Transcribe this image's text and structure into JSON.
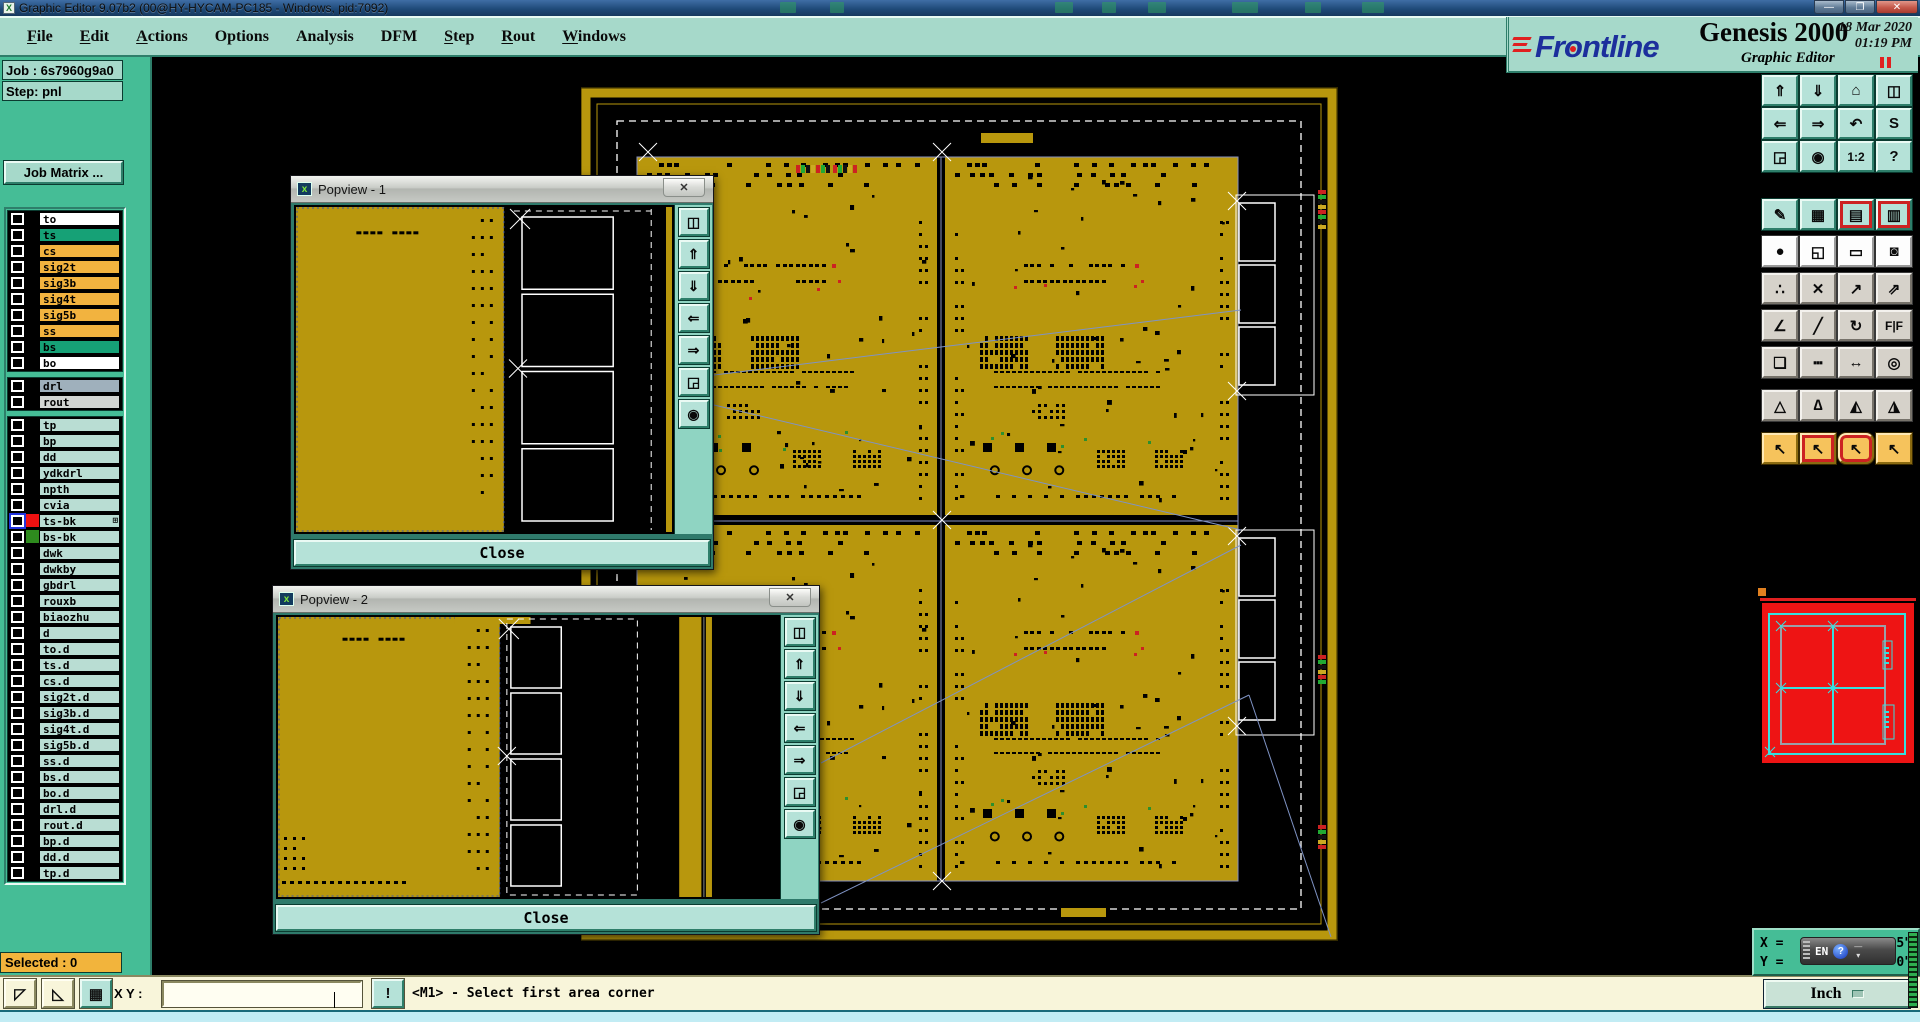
{
  "title_bar": {
    "title": "Graphic Editor 9.07b2 (00@HY-HYCAM-PC185 - Windows, pid:7092)",
    "controls": [
      {
        "name": "minimize",
        "glyph": "—"
      },
      {
        "name": "restore",
        "glyph": "❐"
      },
      {
        "name": "close",
        "glyph": "✕"
      }
    ]
  },
  "menu_bar": {
    "items": [
      {
        "label": "File",
        "u": 0
      },
      {
        "label": "Edit",
        "u": 0
      },
      {
        "label": "Actions",
        "u": 0
      },
      {
        "label": "Options",
        "u": -1
      },
      {
        "label": "Analysis",
        "u": -1
      },
      {
        "label": "DFM",
        "u": -1
      },
      {
        "label": "Step",
        "u": 0
      },
      {
        "label": "Rout",
        "u": 0
      },
      {
        "label": "Windows",
        "u": 0
      }
    ],
    "help": {
      "label": "Help"
    }
  },
  "branding": {
    "logo": "Frontline",
    "product": "Genesis 2000",
    "subtitle": "Graphic Editor",
    "date": "18 Mar 2020",
    "time": "01:19 PM"
  },
  "sidebar": {
    "job": "Job : 6s7960g9a0",
    "step": "Step: pnl",
    "job_matrix": "Job Matrix ...",
    "selected": "Selected : 0",
    "layer_groups": [
      {
        "rows": [
          {
            "label": "to",
            "bg": "#ffffff"
          },
          {
            "label": "ts",
            "bg": "#16a176"
          },
          {
            "label": "cs",
            "bg": "#f2b33f"
          },
          {
            "label": "sig2t",
            "bg": "#f2b33f"
          },
          {
            "label": "sig3b",
            "bg": "#f2b33f"
          },
          {
            "label": "sig4t",
            "bg": "#f2b33f"
          },
          {
            "label": "sig5b",
            "bg": "#f2b33f"
          },
          {
            "label": "ss",
            "bg": "#f2b33f"
          },
          {
            "label": "bs",
            "bg": "#16a176"
          },
          {
            "label": "bo",
            "bg": "#ffffff"
          }
        ]
      },
      {
        "rows": [
          {
            "label": "drl",
            "bg": "#9fb0bc"
          },
          {
            "label": "rout",
            "bg": "#d2d5d2"
          }
        ]
      },
      {
        "rows": [
          {
            "label": "tp",
            "bg": "#b9ddd3"
          },
          {
            "label": "bp",
            "bg": "#b9ddd3"
          },
          {
            "label": "dd",
            "bg": "#b9ddd3"
          },
          {
            "label": "ydkdrl",
            "bg": "#b9ddd3"
          },
          {
            "label": "npth",
            "bg": "#b9ddd3"
          },
          {
            "label": "cvia",
            "bg": "#b9ddd3"
          },
          {
            "label": "ts-bk",
            "bg": "#b9ddd3",
            "swatch": "#ee1111",
            "cb_accent": true,
            "mark": "⊞"
          },
          {
            "label": "bs-bk",
            "bg": "#b9ddd3",
            "swatch": "#2e8b1e"
          },
          {
            "label": "dwk",
            "bg": "#b9ddd3"
          },
          {
            "label": "dwkby",
            "bg": "#b9ddd3"
          },
          {
            "label": "gbdrl",
            "bg": "#b9ddd3"
          },
          {
            "label": "rouxb",
            "bg": "#b9ddd3"
          },
          {
            "label": "biaozhu",
            "bg": "#b9ddd3"
          },
          {
            "label": "d",
            "bg": "#b9ddd3"
          },
          {
            "label": "to.d",
            "bg": "#b9ddd3"
          },
          {
            "label": "ts.d",
            "bg": "#b9ddd3"
          },
          {
            "label": "cs.d",
            "bg": "#b9ddd3"
          },
          {
            "label": "sig2t.d",
            "bg": "#b9ddd3"
          },
          {
            "label": "sig3b.d",
            "bg": "#b9ddd3"
          },
          {
            "label": "sig4t.d",
            "bg": "#b9ddd3"
          },
          {
            "label": "sig5b.d",
            "bg": "#b9ddd3"
          },
          {
            "label": "ss.d",
            "bg": "#b9ddd3"
          },
          {
            "label": "bs.d",
            "bg": "#b9ddd3"
          },
          {
            "label": "bo.d",
            "bg": "#b9ddd3"
          },
          {
            "label": "drl.d",
            "bg": "#b9ddd3"
          },
          {
            "label": "rout.d",
            "bg": "#b9ddd3"
          },
          {
            "label": "bp.d",
            "bg": "#b9ddd3"
          },
          {
            "label": "dd.d",
            "bg": "#b9ddd3"
          },
          {
            "label": "tp.d",
            "bg": "#b9ddd3"
          }
        ]
      }
    ]
  },
  "popviews": [
    {
      "title": "Popview - 1",
      "close": "Close"
    },
    {
      "title": "Popview - 2",
      "close": "Close"
    }
  ],
  "popview_toolbar": [
    {
      "n": "detach-view",
      "g": "◫"
    },
    {
      "n": "pan-up",
      "g": "⇑"
    },
    {
      "n": "pan-down",
      "g": "⇓"
    },
    {
      "n": "pan-left",
      "g": "⇐"
    },
    {
      "n": "pan-right",
      "g": "⇒"
    },
    {
      "n": "zoom-out",
      "g": "◲"
    },
    {
      "n": "zoom-in",
      "g": "◉"
    }
  ],
  "right_toolbar": {
    "rows": [
      {
        "style": "teal",
        "buttons": [
          {
            "n": "pan-up",
            "g": "⇑"
          },
          {
            "n": "pan-down",
            "g": "⇓"
          },
          {
            "n": "home-view",
            "g": "⌂"
          },
          {
            "n": "zoom-window-xy",
            "g": "◫"
          }
        ]
      },
      {
        "style": "teal",
        "buttons": [
          {
            "n": "pan-left",
            "g": "⇐"
          },
          {
            "n": "pan-right",
            "g": "⇒"
          },
          {
            "n": "previous-view",
            "g": "↶"
          },
          {
            "n": "repeat-view",
            "g": "S"
          }
        ]
      },
      {
        "style": "teal",
        "buttons": [
          {
            "n": "zoom-out",
            "g": "◲"
          },
          {
            "n": "zoom-in",
            "g": "◉"
          },
          {
            "n": "scale-1-2",
            "g": "1:2"
          },
          {
            "n": "query-feature",
            "g": "?"
          }
        ]
      },
      {
        "style": "teal",
        "buttons": [
          {
            "n": "editor-setup",
            "g": "✎"
          },
          {
            "n": "snap-grid",
            "g": "▦"
          },
          {
            "n": "layer-display-a",
            "g": "▤",
            "s": "teal red-frame"
          },
          {
            "n": "layer-display-b",
            "g": "▥",
            "s": "teal red-frame"
          }
        ]
      },
      {
        "style": "white",
        "buttons": [
          {
            "n": "select-pad",
            "g": "●"
          },
          {
            "n": "highlight-net",
            "g": "◱"
          },
          {
            "n": "measure-ruler",
            "g": "▭"
          },
          {
            "n": "select-area-pad",
            "g": "◙"
          }
        ]
      },
      {
        "style": "gray",
        "buttons": [
          {
            "n": "net-endpoints",
            "g": "∴"
          },
          {
            "n": "unselect-all",
            "g": "✕"
          },
          {
            "n": "move-feature",
            "g": "↗"
          },
          {
            "n": "copy-feature",
            "g": "⇗"
          }
        ]
      },
      {
        "style": "gray",
        "buttons": [
          {
            "n": "measure-angle",
            "g": "∠"
          },
          {
            "n": "slant-line",
            "g": "╱"
          },
          {
            "n": "rotate-feature",
            "g": "↻"
          },
          {
            "n": "mirror-feature",
            "g": "F|F"
          }
        ]
      },
      {
        "style": "gray",
        "buttons": [
          {
            "n": "copy-to-layer",
            "g": "❏"
          },
          {
            "n": "break-line",
            "g": "┅"
          },
          {
            "n": "resize-feature",
            "g": "↔"
          },
          {
            "n": "surface-tool",
            "g": "◎"
          }
        ]
      },
      {
        "style": "gray",
        "buttons": [
          {
            "n": "arc-fillet-a",
            "g": "△"
          },
          {
            "n": "arc-fillet-b",
            "g": "∆"
          },
          {
            "n": "arc-fillet-c",
            "g": "◭"
          },
          {
            "n": "arc-fillet-d",
            "g": "◮"
          }
        ]
      },
      {
        "style": "orange",
        "buttons": [
          {
            "n": "select-mode-single",
            "g": "↖"
          },
          {
            "n": "select-mode-frame",
            "g": "↖",
            "s": "orange red-inner"
          },
          {
            "n": "select-mode-poly",
            "g": "↖",
            "s": "orange red-oct"
          },
          {
            "n": "select-mode-net",
            "g": "↖"
          }
        ]
      }
    ]
  },
  "status_bar": {
    "tools": [
      {
        "n": "profile-corner-a",
        "g": "◸"
      },
      {
        "n": "profile-corner-b",
        "g": "◺"
      },
      {
        "n": "grid-snap-toggle",
        "g": "▦",
        "teal": true
      }
    ],
    "xy_label": "X Y :",
    "input_value": "",
    "bang": "!",
    "prompt": "<M1> - Select first area corner",
    "units": "Inch"
  },
  "readout": {
    "x_label": "X =",
    "y_label": "Y =",
    "x_visible": "5\"",
    "y_visible": "0\"",
    "ime": {
      "lang": "EN",
      "help": "?",
      "minimize": "—",
      "arrow": "▾"
    }
  },
  "colors": {
    "copper": "#b8970d",
    "teal_ui": "#a6d9ca",
    "sidebar": "#45bd96",
    "overview_red": "#ee1414",
    "overview_cyan": "#35e0e0",
    "link_line": "#7f93c4",
    "statusbar": "#f8f5da",
    "selected_badge": "#f2b43c"
  },
  "canvas_decoration": {
    "seed": 13,
    "quads": 4,
    "note": "2x2 panelized PCB array"
  }
}
